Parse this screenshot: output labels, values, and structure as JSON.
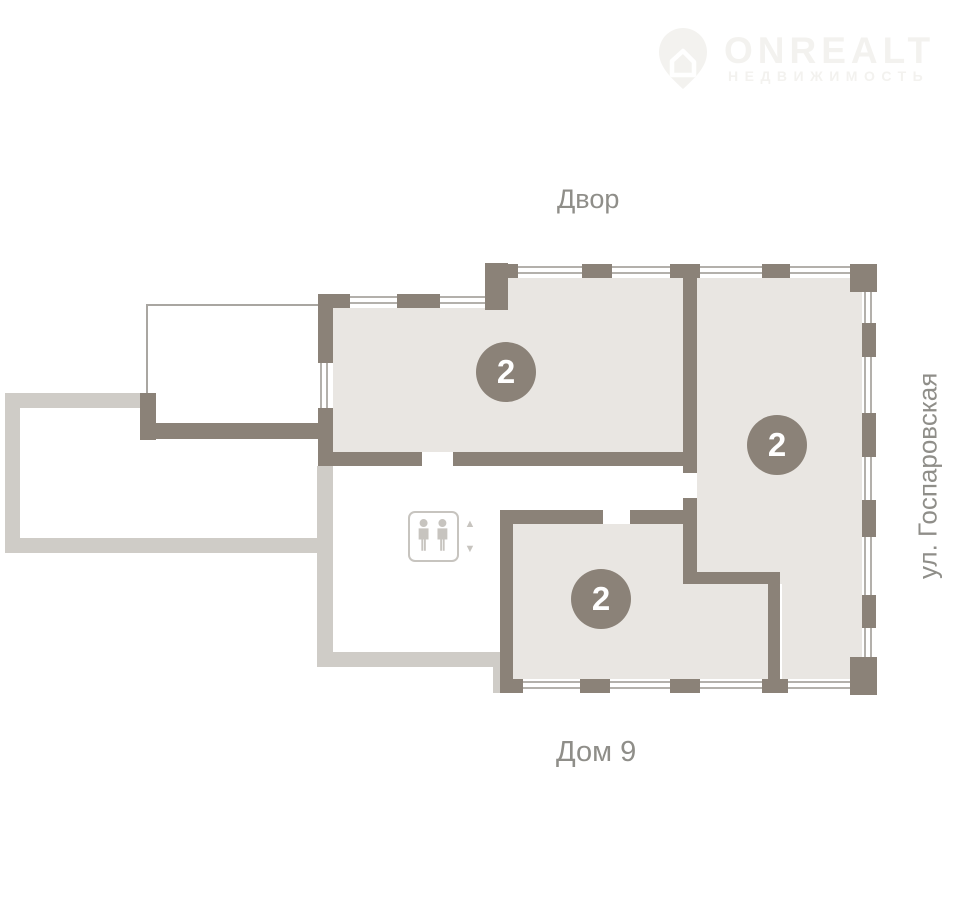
{
  "logo": {
    "brand": "ONREALT",
    "subtitle": "НЕДВИЖИМОСТЬ"
  },
  "labels": {
    "top": "Двор",
    "bottom": "Дом 9",
    "right_street": "ул. Госпаровская"
  },
  "plan": {
    "rooms": [
      {
        "id": "room-1",
        "badge": "2"
      },
      {
        "id": "room-2",
        "badge": "2"
      },
      {
        "id": "room-3",
        "badge": "2"
      }
    ]
  },
  "icons": {
    "arrow_up": "▲",
    "arrow_down": "▼"
  },
  "colors": {
    "bg": "#ffffff",
    "wall_dark": "#8b8278",
    "wall_light": "#cfccc7",
    "room_fill": "#e9e6e2",
    "window_line": "#b3b0ab",
    "rail_line": "#a9a6a1",
    "icon_gray": "#c7c4bf",
    "label_text": "#8f8e89",
    "badge_fill": "#8b8278",
    "badge_text": "#ffffff",
    "logo_color": "#f3f2ef"
  }
}
